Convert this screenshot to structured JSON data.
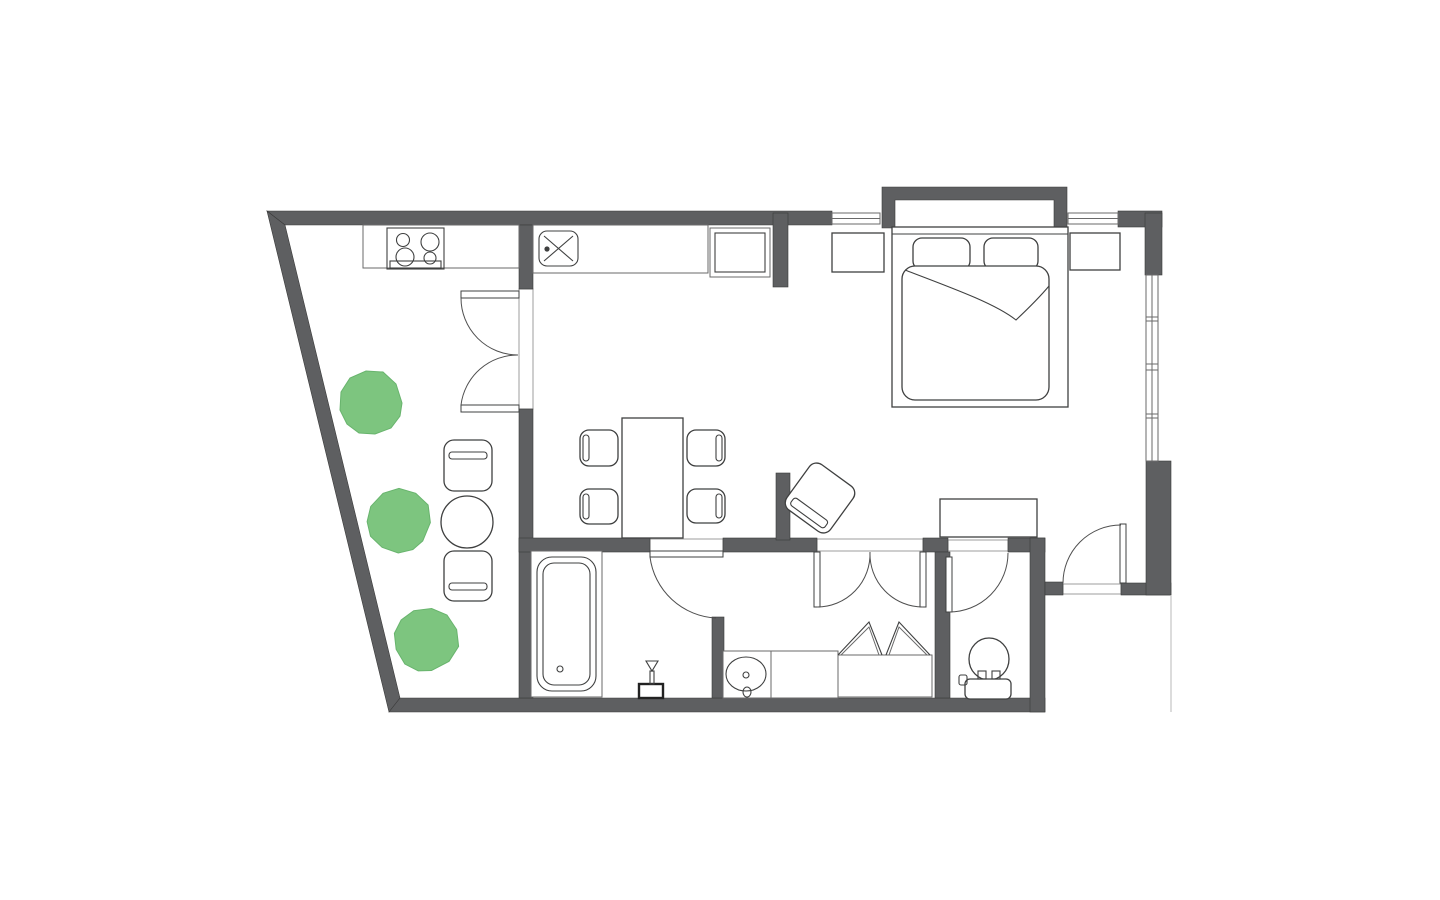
{
  "canvas": {
    "width": 1440,
    "height": 900,
    "background": "#ffffff"
  },
  "palette": {
    "wall": "#5e5f61",
    "outline": "#3f4040",
    "light_outline": "#9c9c9c",
    "door_arc": "#4f4f4f",
    "plant_fill": "#7dc57f",
    "plant_stroke": "#68b46d",
    "thin_ref_line": "#b9b9b9"
  },
  "floorplan": {
    "type": "apartment-floor-plan",
    "inventory": [
      {
        "area": "terrace",
        "items": [
          {
            "name": "plant",
            "count": 3
          },
          {
            "name": "bistro-table",
            "count": 1
          },
          {
            "name": "bistro-chair",
            "count": 2
          }
        ]
      },
      {
        "area": "kitchen",
        "items": [
          {
            "name": "counter",
            "count": 2
          },
          {
            "name": "cooktop-4-burner",
            "count": 1
          },
          {
            "name": "sink",
            "count": 1
          },
          {
            "name": "refrigerator",
            "count": 1
          }
        ]
      },
      {
        "area": "dining",
        "items": [
          {
            "name": "dining-table",
            "count": 1
          },
          {
            "name": "dining-chair",
            "count": 4
          }
        ]
      },
      {
        "area": "living",
        "items": [
          {
            "name": "armchair",
            "count": 1
          },
          {
            "name": "sideboard",
            "count": 1
          }
        ]
      },
      {
        "area": "bedroom",
        "items": [
          {
            "name": "double-bed",
            "count": 1
          },
          {
            "name": "pillow",
            "count": 2
          },
          {
            "name": "blanket",
            "count": 1
          },
          {
            "name": "nightstand",
            "count": 2
          },
          {
            "name": "bay-niche",
            "count": 1
          },
          {
            "name": "window",
            "count": 2
          },
          {
            "name": "window-strip",
            "count": 1
          }
        ]
      },
      {
        "area": "bathroom",
        "items": [
          {
            "name": "bathtub",
            "count": 1
          },
          {
            "name": "brush-stand",
            "count": 1
          }
        ]
      },
      {
        "area": "dressing",
        "items": [
          {
            "name": "vanity-counter",
            "count": 1
          },
          {
            "name": "washbasin",
            "count": 1
          },
          {
            "name": "wardrobe-bifold",
            "count": 1
          }
        ]
      },
      {
        "area": "wc",
        "items": [
          {
            "name": "toilet",
            "count": 1
          }
        ]
      },
      {
        "area": "doors",
        "items": [
          {
            "name": "terrace-double-door",
            "count": 1
          },
          {
            "name": "bathroom-door",
            "count": 1
          },
          {
            "name": "double-swing-door",
            "count": 1
          },
          {
            "name": "wc-door",
            "count": 1
          },
          {
            "name": "entry-door",
            "count": 1
          }
        ]
      }
    ]
  }
}
